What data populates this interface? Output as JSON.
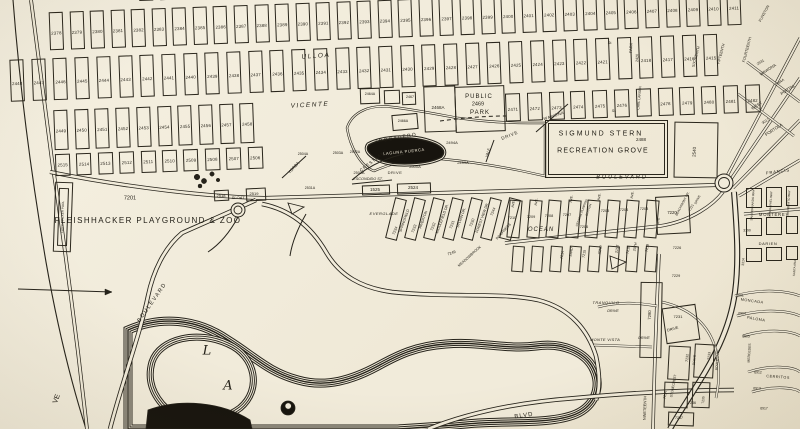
{
  "palette": {
    "paper": "#f1ebda",
    "ink": "#26231b",
    "dark_water": "#17140e"
  },
  "grid": {
    "rowA": [
      "2378",
      "2379",
      "2380",
      "2381",
      "2382",
      "2383",
      "2384",
      "2385",
      "2386",
      "2387",
      "2388",
      "2389",
      "2390",
      "2391",
      "2392",
      "2393",
      "2394",
      "2395",
      "2396",
      "2397",
      "2398",
      "2399",
      "2400",
      "2401",
      "2402",
      "2403",
      "2404",
      "2405",
      "2406",
      "2407",
      "2408",
      "2409",
      "2410",
      "2411"
    ],
    "rowB": [
      "2448",
      "2447",
      "2446",
      "2445",
      "2444",
      "2443",
      "2442",
      "2441",
      "2440",
      "2439",
      "2438",
      "2437",
      "2436",
      "2435",
      "2434",
      "2433",
      "2432",
      "2431",
      "2430",
      "2429",
      "2428",
      "2427",
      "2426",
      "2425",
      "2424",
      "2423",
      "2422",
      "2421",
      "",
      "2418",
      "2417",
      "2416",
      "2415"
    ],
    "rowC_left": [
      "2449",
      "2450",
      "2451",
      "2452",
      "2453",
      "2454",
      "2455",
      "2456",
      "2457",
      "2458"
    ],
    "rowC_right": [
      "2471",
      "2472",
      "2473",
      "2474",
      "2475",
      "2476",
      "",
      "2478",
      "2479",
      "2480",
      "2481",
      "2482"
    ],
    "rowD": [
      "2515",
      "2514",
      "2513",
      "2512",
      "2511",
      "2510",
      "2509",
      "2508",
      "2507",
      "2506"
    ]
  },
  "labels": [
    {
      "t": "FLEISHHACKER PLAYGROUND & ZOO",
      "x": 148,
      "y": 221,
      "s": 8,
      "w": 1.4
    },
    {
      "t": "7201",
      "x": 130,
      "y": 199,
      "s": 5.5
    },
    {
      "t": "FLEISHHACKER POOL",
      "x": 63,
      "y": 217,
      "s": 3,
      "r": -88
    },
    {
      "t": "SIGMUND STERN",
      "x": 601,
      "y": 134,
      "s": 7,
      "w": 2
    },
    {
      "t": "RECREATION GROVE",
      "x": 603,
      "y": 151,
      "s": 7,
      "w": 1.2
    },
    {
      "t": "PUBLIC",
      "x": 479,
      "y": 97,
      "s": 6,
      "w": 1
    },
    {
      "t": "2469",
      "x": 478,
      "y": 105,
      "s": 5.5
    },
    {
      "t": "PARK",
      "x": 480,
      "y": 113,
      "s": 6,
      "w": 1
    },
    {
      "t": "ULLOA",
      "x": 316,
      "y": 57,
      "s": 6.5,
      "i": 1,
      "r": -4,
      "w": 1.5
    },
    {
      "t": "VICENTE",
      "x": 310,
      "y": 106,
      "s": 6.5,
      "i": 1,
      "r": -3,
      "w": 1.5
    },
    {
      "t": "TROCADERO",
      "x": 396,
      "y": 139,
      "s": 5,
      "r": -10,
      "w": 1.2
    },
    {
      "t": "LAGUNA PUERCA",
      "x": 404,
      "y": 152,
      "s": 4,
      "r": -6,
      "c": "wh",
      "w": 0.6
    },
    {
      "t": "2518",
      "x": 221,
      "y": 196,
      "s": 4
    },
    {
      "t": "SLOAT",
      "x": 238,
      "y": 198,
      "s": 4,
      "i": 1
    },
    {
      "t": "2519",
      "x": 254,
      "y": 194,
      "s": 4
    },
    {
      "t": "BOULEVARD",
      "x": 622,
      "y": 178,
      "s": 5.5,
      "w": 2,
      "i": 1
    },
    {
      "t": "OCEAN",
      "x": 541,
      "y": 230,
      "s": 6,
      "i": 1,
      "w": 1
    },
    {
      "t": "BLVD",
      "x": 524,
      "y": 416,
      "s": 6,
      "r": -8,
      "w": 1
    },
    {
      "t": "BOULEVARD",
      "x": 153,
      "y": 303,
      "s": 5.5,
      "r": -55,
      "w": 1.5
    },
    {
      "t": "L",
      "x": 207,
      "y": 351,
      "s": 13,
      "i": 1,
      "c": "serif"
    },
    {
      "t": "A",
      "x": 228,
      "y": 386,
      "s": 13,
      "i": 1,
      "c": "serif"
    },
    {
      "t": "VE",
      "x": 57,
      "y": 399,
      "s": 7,
      "r": -70
    },
    {
      "t": "2488",
      "x": 641,
      "y": 140,
      "s": 4.5
    },
    {
      "t": "2540",
      "x": 695,
      "y": 152,
      "s": 4.5,
      "r": -87
    },
    {
      "t": "2494A",
      "x": 452,
      "y": 143,
      "s": 4
    },
    {
      "t": "2499A",
      "x": 463,
      "y": 163,
      "s": 4
    },
    {
      "t": "2500A",
      "x": 415,
      "y": 167,
      "s": 4
    },
    {
      "t": "CRESTLAKE",
      "x": 374,
      "y": 161,
      "s": 4.5,
      "r": -38,
      "w": 0.8
    },
    {
      "t": "DRIVE",
      "x": 395,
      "y": 173,
      "s": 4,
      "w": 0.5
    },
    {
      "t": "VALE",
      "x": 489,
      "y": 153,
      "s": 3.8,
      "r": -72
    },
    {
      "t": "DRIVE",
      "x": 510,
      "y": 136,
      "s": 4.5,
      "r": -22,
      "w": 0.8
    },
    {
      "t": "2501A",
      "x": 359,
      "y": 174,
      "s": 3.8
    },
    {
      "t": "ESCONDIDO ST.",
      "x": 368,
      "y": 180,
      "s": 3.8,
      "i": 1
    },
    {
      "t": "1525",
      "x": 375,
      "y": 190,
      "s": 4.5
    },
    {
      "t": "2524",
      "x": 413,
      "y": 188,
      "s": 4.5
    },
    {
      "t": "YORBA",
      "x": 294,
      "y": 168,
      "s": 4.2,
      "r": -48
    },
    {
      "t": "2504A",
      "x": 303,
      "y": 155,
      "s": 3.6
    },
    {
      "t": "2503A",
      "x": 338,
      "y": 154,
      "s": 3.6
    },
    {
      "t": "2502A",
      "x": 355,
      "y": 153,
      "s": 3.6
    },
    {
      "t": "2531A",
      "x": 310,
      "y": 189,
      "s": 3.6
    },
    {
      "t": "2464A",
      "x": 370,
      "y": 95,
      "s": 3.6
    },
    {
      "t": "2467",
      "x": 410,
      "y": 98,
      "s": 3.6
    },
    {
      "t": "2466A",
      "x": 403,
      "y": 122,
      "s": 3.6
    },
    {
      "t": "2468A",
      "x": 438,
      "y": 108,
      "s": 4.5
    },
    {
      "t": "WAWONA",
      "x": 554,
      "y": 116,
      "s": 4,
      "r": -18,
      "w": 0.5
    },
    {
      "t": "SIXTEENTH",
      "x": 697,
      "y": 57,
      "s": 3.8,
      "r": -75
    },
    {
      "t": "FIFTEENTH",
      "x": 722,
      "y": 54,
      "s": 3.8,
      "r": -75
    },
    {
      "t": "FOURTEENTH",
      "x": 748,
      "y": 50,
      "s": 3.8,
      "r": -75
    },
    {
      "t": "FUNSTON",
      "x": 765,
      "y": 14,
      "s": 3.8,
      "r": -62
    },
    {
      "t": "PARK",
      "x": 632,
      "y": 48,
      "s": 3.8,
      "r": -88
    },
    {
      "t": "2420",
      "x": 638,
      "y": 58,
      "s": 3.6,
      "r": -88
    },
    {
      "t": "St.",
      "x": 610,
      "y": 44,
      "s": 3.6,
      "i": 1
    },
    {
      "t": "St.",
      "x": 614,
      "y": 112,
      "s": 3.6,
      "i": 1
    },
    {
      "t": "CARL LARSEN",
      "x": 640,
      "y": 98,
      "s": 3.4,
      "r": -85
    },
    {
      "t": "2931",
      "x": 761,
      "y": 63,
      "s": 3.6,
      "r": -33
    },
    {
      "t": "WAWONA",
      "x": 768,
      "y": 70,
      "s": 4,
      "r": -33
    },
    {
      "t": "2984A",
      "x": 780,
      "y": 83,
      "s": 3.6,
      "r": -33
    },
    {
      "t": "PORTAL",
      "x": 788,
      "y": 90,
      "s": 4.2,
      "r": -33
    },
    {
      "t": "WEST",
      "x": 757,
      "y": 106,
      "s": 4.2,
      "r": -33
    },
    {
      "t": "3017",
      "x": 766,
      "y": 122,
      "s": 3.6,
      "r": -33
    },
    {
      "t": "PORTOLA",
      "x": 774,
      "y": 130,
      "s": 4.2,
      "r": -33
    },
    {
      "t": "FRANCIS",
      "x": 778,
      "y": 172,
      "s": 4.2,
      "r": -8,
      "w": 0.8
    },
    {
      "t": "EVERGLADE",
      "x": 384,
      "y": 214,
      "s": 4,
      "i": 1,
      "w": 0.5
    },
    {
      "t": "7234",
      "x": 396,
      "y": 231,
      "s": 3.8,
      "r": -70
    },
    {
      "t": "SPRINGFIELD",
      "x": 405,
      "y": 221,
      "s": 3.6,
      "r": -70
    },
    {
      "t": "7233",
      "x": 415,
      "y": 229,
      "s": 3.8,
      "r": -70
    },
    {
      "t": "RIVERTON",
      "x": 424,
      "y": 220,
      "s": 3.6,
      "r": -70
    },
    {
      "t": "7232",
      "x": 434,
      "y": 227,
      "s": 3.8,
      "r": -70
    },
    {
      "t": "MIDDLEFIELD DR.",
      "x": 443,
      "y": 219,
      "s": 3.6,
      "r": -70
    },
    {
      "t": "7231",
      "x": 453,
      "y": 225,
      "s": 3.8,
      "r": -70
    },
    {
      "t": "SYLVAN DR.",
      "x": 462,
      "y": 218,
      "s": 3.6,
      "r": -70
    },
    {
      "t": "7230",
      "x": 473,
      "y": 223,
      "s": 3.8,
      "r": -70
    },
    {
      "t": "FOREST VIEW DR.",
      "x": 483,
      "y": 218,
      "s": 3.6,
      "r": -70
    },
    {
      "t": "7244",
      "x": 494,
      "y": 212,
      "s": 3.8,
      "r": -70
    },
    {
      "t": "INVERNESS",
      "x": 504,
      "y": 232,
      "s": 3.6,
      "r": -48
    },
    {
      "t": "7249",
      "x": 452,
      "y": 254,
      "s": 3.8,
      "r": -20
    },
    {
      "t": "MEADOWBROOK",
      "x": 470,
      "y": 257,
      "s": 3.6,
      "r": -42
    },
    {
      "t": "AVE.",
      "x": 514,
      "y": 204,
      "s": 3.4,
      "r": -80
    },
    {
      "t": "AVE.",
      "x": 537,
      "y": 202,
      "s": 3.4,
      "r": -80
    },
    {
      "t": "AVE.",
      "x": 572,
      "y": 199,
      "s": 3.4,
      "r": -80
    },
    {
      "t": "AVE.",
      "x": 600,
      "y": 197,
      "s": 3.4,
      "r": -80
    },
    {
      "t": "AVE.",
      "x": 633,
      "y": 195,
      "s": 3.4,
      "r": -80
    },
    {
      "t": "7210",
      "x": 512,
      "y": 219,
      "s": 3.8
    },
    {
      "t": "7209",
      "x": 531,
      "y": 218,
      "s": 3.8
    },
    {
      "t": "7208",
      "x": 549,
      "y": 217,
      "s": 3.8
    },
    {
      "t": "7207",
      "x": 567,
      "y": 216,
      "s": 3.8
    },
    {
      "t": "CENTRAL PUMPING",
      "x": 582,
      "y": 213,
      "s": 3,
      "r": -70
    },
    {
      "t": "STATION",
      "x": 589,
      "y": 210,
      "s": 3,
      "r": -70
    },
    {
      "t": "7206",
      "x": 584,
      "y": 228,
      "s": 3.8
    },
    {
      "t": "7205",
      "x": 605,
      "y": 212,
      "s": 3.8
    },
    {
      "t": "7204",
      "x": 624,
      "y": 211,
      "s": 3.8
    },
    {
      "t": "7203",
      "x": 644,
      "y": 210,
      "s": 3.8
    },
    {
      "t": "7214",
      "x": 563,
      "y": 255,
      "s": 3.6,
      "r": -80
    },
    {
      "t": "23RD",
      "x": 572,
      "y": 252,
      "s": 3.6,
      "r": -80
    },
    {
      "t": "7215",
      "x": 585,
      "y": 254,
      "s": 3.6,
      "r": -80
    },
    {
      "t": "22ND",
      "x": 601,
      "y": 250,
      "s": 3.6,
      "r": -80
    },
    {
      "t": "21ST",
      "x": 618,
      "y": 249,
      "s": 3.6,
      "r": -80
    },
    {
      "t": "7218",
      "x": 629,
      "y": 250,
      "s": 3.6,
      "r": -80
    },
    {
      "t": "20TH",
      "x": 636,
      "y": 247,
      "s": 3.6,
      "r": -80
    },
    {
      "t": "7219",
      "x": 648,
      "y": 248,
      "s": 3.6,
      "r": -80
    },
    {
      "t": "AVE",
      "x": 659,
      "y": 221,
      "s": 3.4,
      "r": -85
    },
    {
      "t": "7220",
      "x": 672,
      "y": 213,
      "s": 4.2
    },
    {
      "t": "BEACHMONT DR.",
      "x": 683,
      "y": 204,
      "s": 3.2,
      "r": -62
    },
    {
      "t": "7221",
      "x": 692,
      "y": 208,
      "s": 3.4,
      "r": -62
    },
    {
      "t": "DRIVE",
      "x": 698,
      "y": 200,
      "s": 3.2,
      "r": -62
    },
    {
      "t": "MONTEREY",
      "x": 774,
      "y": 215,
      "s": 4.2,
      "w": 0.8
    },
    {
      "t": "SAN FERNANDO WAY",
      "x": 753,
      "y": 205,
      "s": 3,
      "r": -86
    },
    {
      "t": "SAN RAFAEL WAY",
      "x": 771,
      "y": 204,
      "s": 3,
      "r": -86
    },
    {
      "t": "SAN BENITO WAY",
      "x": 789,
      "y": 203,
      "s": 3,
      "r": -86
    },
    {
      "t": "3190",
      "x": 747,
      "y": 231,
      "s": 3.4
    },
    {
      "t": "DARIEN",
      "x": 768,
      "y": 244,
      "s": 4,
      "w": 0.6
    },
    {
      "t": "3314",
      "x": 744,
      "y": 262,
      "s": 3.4,
      "r": -86
    },
    {
      "t": "SANTA ANA",
      "x": 795,
      "y": 268,
      "s": 3,
      "r": -86
    },
    {
      "t": "7226",
      "x": 677,
      "y": 249,
      "s": 3.8
    },
    {
      "t": "7229",
      "x": 676,
      "y": 277,
      "s": 3.8
    },
    {
      "t": "6601",
      "x": 740,
      "y": 296,
      "s": 3.4
    },
    {
      "t": "MONCADA",
      "x": 752,
      "y": 302,
      "s": 3.8,
      "r": 8,
      "w": 0.5
    },
    {
      "t": "6904",
      "x": 742,
      "y": 314,
      "s": 3.4
    },
    {
      "t": "PALOMA",
      "x": 756,
      "y": 320,
      "s": 3.8,
      "r": 10,
      "w": 0.5
    },
    {
      "t": "6905",
      "x": 746,
      "y": 337,
      "s": 3.4
    },
    {
      "t": "MERCEDES",
      "x": 750,
      "y": 353,
      "s": 3.4,
      "r": -86
    },
    {
      "t": "6912",
      "x": 758,
      "y": 373,
      "s": 3.4
    },
    {
      "t": "CERRITOS",
      "x": 778,
      "y": 378,
      "s": 3.8,
      "r": 4,
      "w": 0.5
    },
    {
      "t": "6913",
      "x": 757,
      "y": 389,
      "s": 3.4
    },
    {
      "t": "6917",
      "x": 764,
      "y": 409,
      "s": 3.4
    },
    {
      "t": "7280",
      "x": 650,
      "y": 315,
      "s": 4.2,
      "r": -88
    },
    {
      "t": "TRANQUILO",
      "x": 606,
      "y": 303,
      "s": 4,
      "i": 1,
      "w": 0.4
    },
    {
      "t": "DRIVE",
      "x": 613,
      "y": 312,
      "s": 3.8,
      "i": 1
    },
    {
      "t": "MONTE VISTA",
      "x": 605,
      "y": 340,
      "s": 4,
      "i": 1,
      "w": 0.3
    },
    {
      "t": "DRIVE",
      "x": 644,
      "y": 339,
      "s": 3.8,
      "i": 1
    },
    {
      "t": "NINETEENTH",
      "x": 646,
      "y": 408,
      "s": 3.8,
      "r": -88
    },
    {
      "t": "7231",
      "x": 678,
      "y": 317,
      "s": 4
    },
    {
      "t": "DRIVE",
      "x": 673,
      "y": 330,
      "s": 3.8,
      "r": -15
    },
    {
      "t": "7232",
      "x": 688,
      "y": 358,
      "s": 3.6,
      "r": -86
    },
    {
      "t": "DRIVE",
      "x": 695,
      "y": 360,
      "s": 3.4,
      "r": -86
    },
    {
      "t": "7233",
      "x": 710,
      "y": 356,
      "s": 3.6,
      "r": -86
    },
    {
      "t": "BOULEVARD",
      "x": 718,
      "y": 360,
      "s": 3.4,
      "r": -86
    },
    {
      "t": "STONECREST",
      "x": 674,
      "y": 386,
      "s": 3.4,
      "r": -80
    },
    {
      "t": "7234",
      "x": 666,
      "y": 395,
      "s": 3.6,
      "r": -80
    },
    {
      "t": "7236",
      "x": 692,
      "y": 404,
      "s": 3.6
    },
    {
      "t": "7235",
      "x": 704,
      "y": 400,
      "s": 3.4,
      "r": -86
    },
    {
      "t": "7237",
      "x": 679,
      "y": 419,
      "s": 3.6
    }
  ]
}
